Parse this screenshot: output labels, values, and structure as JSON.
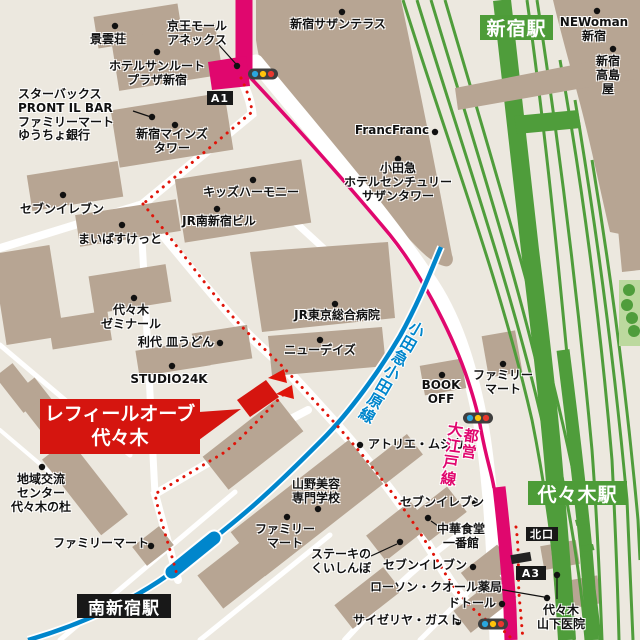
{
  "map_title": "レフィールオーブ代々木 周辺地図",
  "colors": {
    "background": "#ece8df",
    "building": "#b7a593",
    "road": "#ffffff",
    "jr_green": "#4f9d3b",
    "station_badge_green": "#4d9c38",
    "oedo_magenta": "#e0076e",
    "odakyu_blue": "#0086cc",
    "route_red": "#e01409",
    "callout_red": "#d5150f",
    "badge_black": "#181818",
    "park_green": "#bcd99e"
  },
  "callout": {
    "line1": "レフィールオーブ",
    "line2": "代々木"
  },
  "badges": [
    {
      "id": "shinjuku-station",
      "text": "新宿駅",
      "x": 480,
      "y": 15,
      "w": 73,
      "h": 25,
      "bg": "#4d9c38",
      "fs": 19
    },
    {
      "id": "yoyogi-station",
      "text": "代々木駅",
      "x": 528,
      "y": 481,
      "w": 99,
      "h": 24,
      "bg": "#4d9c38",
      "fs": 19
    },
    {
      "id": "minami-shinjuku-station",
      "text": "南新宿駅",
      "x": 77,
      "y": 594,
      "w": 94,
      "h": 24,
      "bg": "#181818",
      "fs": 17
    },
    {
      "id": "exit-a1",
      "text": "A1",
      "x": 207,
      "y": 91,
      "w": 26,
      "h": 14,
      "bg": "#181818",
      "fs": 11
    },
    {
      "id": "exit-a3",
      "text": "A3",
      "x": 516,
      "y": 566,
      "w": 30,
      "h": 14,
      "bg": "#181818",
      "fs": 11
    },
    {
      "id": "north-exit",
      "text": "北口",
      "x": 526,
      "y": 527,
      "w": 32,
      "h": 14,
      "bg": "#181818",
      "fs": 11
    }
  ],
  "rail_labels": [
    {
      "id": "odakyu-odawara-line",
      "text": "小田急小田原線",
      "x": 391,
      "y": 372,
      "rot": 30,
      "color": "#0086cc",
      "fs": 15.5
    },
    {
      "id": "toei",
      "text": "都営",
      "x": 470,
      "y": 444,
      "rot": 8,
      "color": "#e0076e",
      "fs": 15
    },
    {
      "id": "oedo-line",
      "text": "大江戸線",
      "x": 451,
      "y": 454,
      "rot": 8,
      "color": "#e0076e",
      "fs": 15.5
    }
  ],
  "labels": [
    {
      "id": "keiunso",
      "text": "景雲荘",
      "x": 108,
      "y": 33,
      "align": "center"
    },
    {
      "id": "keio-mall-annex",
      "text": "京王モール\nアネックス",
      "x": 197,
      "y": 20,
      "align": "center"
    },
    {
      "id": "hotel-sunroute",
      "text": "ホテルサンルート\nプラザ新宿",
      "x": 157,
      "y": 60,
      "align": "center"
    },
    {
      "id": "starbucks-group",
      "text": "スターバックス\nPRONT IL BAR\nファミリーマート\nゆうちょ銀行",
      "x": 18,
      "y": 88,
      "align": "left"
    },
    {
      "id": "southern-terrace",
      "text": "新宿サザンテラス",
      "x": 338,
      "y": 18,
      "align": "center"
    },
    {
      "id": "newoman",
      "text": "NEWoman\n新宿",
      "x": 594,
      "y": 16,
      "align": "center"
    },
    {
      "id": "takashimaya",
      "text": "新宿\n高島屋",
      "x": 608,
      "y": 55,
      "align": "center"
    },
    {
      "id": "francfranc",
      "text": "FrancFranc",
      "x": 392,
      "y": 124,
      "align": "center"
    },
    {
      "id": "mynds-tower",
      "text": "新宿マインズ\nタワー",
      "x": 172,
      "y": 128,
      "align": "center"
    },
    {
      "id": "odakyu-hotel",
      "text": "小田急\nホテルセンチュリー\nサザンタワー",
      "x": 398,
      "y": 162,
      "align": "center"
    },
    {
      "id": "kids-harmony",
      "text": "キッズハーモニー",
      "x": 251,
      "y": 186,
      "align": "center"
    },
    {
      "id": "jr-minamishinjuku",
      "text": "JR南新宿ビル",
      "x": 219,
      "y": 215,
      "align": "center"
    },
    {
      "id": "seven-nw",
      "text": "セブンイレブン",
      "x": 62,
      "y": 203,
      "align": "center"
    },
    {
      "id": "maibasuketto",
      "text": "まいばすけっと",
      "x": 120,
      "y": 233,
      "align": "center"
    },
    {
      "id": "yoyogi-seminar",
      "text": "代々木\nゼミナール",
      "x": 131,
      "y": 304,
      "align": "center"
    },
    {
      "id": "toshiro-saraudon",
      "text": "利代 皿うどん",
      "x": 176,
      "y": 336,
      "align": "center"
    },
    {
      "id": "studio24k",
      "text": "STUDIO24K",
      "x": 169,
      "y": 373,
      "align": "center"
    },
    {
      "id": "jr-tokyo-hospital",
      "text": "JR東京総合病院",
      "x": 337,
      "y": 309,
      "align": "center"
    },
    {
      "id": "newdays",
      "text": "ニューデイズ",
      "x": 320,
      "y": 344,
      "align": "center"
    },
    {
      "id": "bookoff",
      "text": "BOOK\nOFF",
      "x": 441,
      "y": 379,
      "align": "center"
    },
    {
      "id": "familymart-east",
      "text": "ファミリー\nマート",
      "x": 503,
      "y": 369,
      "align": "center"
    },
    {
      "id": "atelier-musica",
      "text": "アトリエ・ムジカ",
      "x": 368,
      "y": 438,
      "align": "left"
    },
    {
      "id": "chiiki-koryu",
      "text": "地域交流\nセンター\n代々木の杜",
      "x": 41,
      "y": 473,
      "align": "center"
    },
    {
      "id": "yamano-beauty",
      "text": "山野美容\n専門学校",
      "x": 316,
      "y": 478,
      "align": "center"
    },
    {
      "id": "familymart-south",
      "text": "ファミリー\nマート",
      "x": 285,
      "y": 523,
      "align": "center"
    },
    {
      "id": "steak-kuishinbo",
      "text": "ステーキの\nくいしんぼ",
      "x": 341,
      "y": 548,
      "align": "center"
    },
    {
      "id": "seven-mid",
      "text": "セブンイレブン",
      "x": 400,
      "y": 496,
      "align": "left"
    },
    {
      "id": "chuka-ichibankan",
      "text": "中華食堂\n一番館",
      "x": 461,
      "y": 523,
      "align": "center"
    },
    {
      "id": "seven-south",
      "text": "セブンイレブン",
      "x": 383,
      "y": 559,
      "align": "left"
    },
    {
      "id": "lawson-qol",
      "text": "ローソン・クオール薬局",
      "x": 370,
      "y": 581,
      "align": "left"
    },
    {
      "id": "doutor",
      "text": "ドトール",
      "x": 448,
      "y": 597,
      "align": "left"
    },
    {
      "id": "saizeriya-gusto",
      "text": "サイゼリヤ・ガスト",
      "x": 353,
      "y": 614,
      "align": "left"
    },
    {
      "id": "yoyogi-yamashita",
      "text": "代々木\n山下医院",
      "x": 561,
      "y": 604,
      "align": "center"
    },
    {
      "id": "familymart-sw",
      "text": "ファミリーマート",
      "x": 53,
      "y": 537,
      "align": "left"
    }
  ],
  "poi_dots": [
    [
      115,
      26
    ],
    [
      237,
      66
    ],
    [
      157,
      52
    ],
    [
      152,
      117
    ],
    [
      175,
      125
    ],
    [
      342,
      12
    ],
    [
      597,
      11
    ],
    [
      613,
      49
    ],
    [
      435,
      132
    ],
    [
      398,
      159
    ],
    [
      253,
      180
    ],
    [
      217,
      209
    ],
    [
      63,
      195
    ],
    [
      122,
      225
    ],
    [
      134,
      298
    ],
    [
      220,
      343
    ],
    [
      172,
      366
    ],
    [
      335,
      304
    ],
    [
      320,
      340
    ],
    [
      442,
      375
    ],
    [
      503,
      364
    ],
    [
      360,
      445
    ],
    [
      42,
      467
    ],
    [
      318,
      509
    ],
    [
      287,
      517
    ],
    [
      400,
      542
    ],
    [
      475,
      503
    ],
    [
      428,
      518
    ],
    [
      473,
      567
    ],
    [
      547,
      598
    ],
    [
      502,
      604
    ],
    [
      458,
      622
    ],
    [
      557,
      575
    ],
    [
      151,
      546
    ]
  ],
  "leader_lines": [
    [
      218,
      44,
      236,
      64
    ],
    [
      133,
      111,
      151,
      117
    ],
    [
      371,
      556,
      397,
      544
    ],
    [
      498,
      589,
      544,
      597
    ],
    [
      431,
      521,
      441,
      528
    ],
    [
      557,
      577,
      557,
      599
    ]
  ],
  "traffic_lights": [
    [
      263,
      74
    ],
    [
      478,
      418
    ],
    [
      493,
      624
    ]
  ]
}
